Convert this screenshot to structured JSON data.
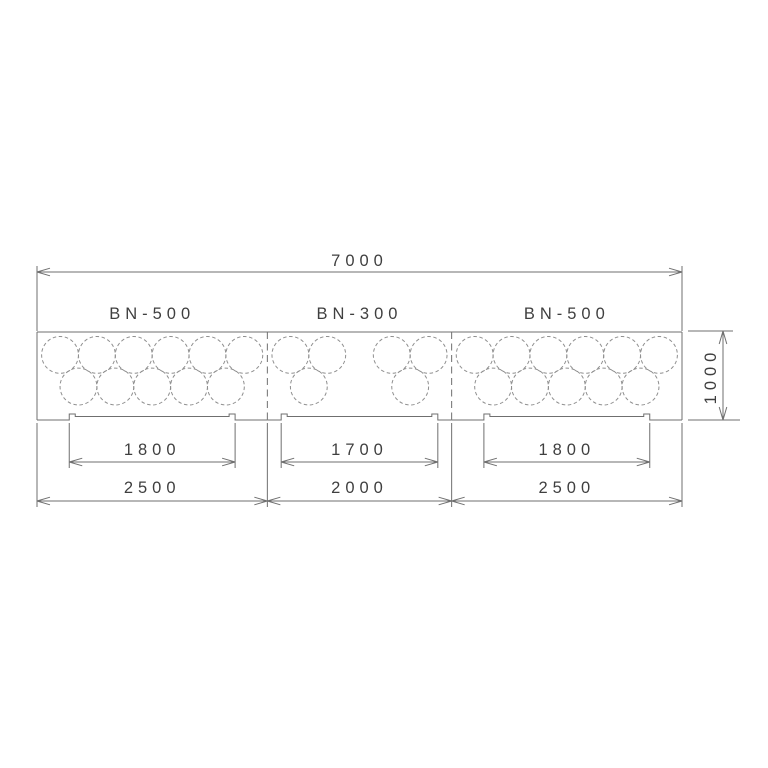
{
  "drawing": {
    "type": "plan-view-technical-drawing",
    "overall": {
      "length_label": "7000",
      "length_mm": 7000,
      "height_label": "1000",
      "height_mm": 1000
    },
    "sections": [
      {
        "label": "BN-500",
        "width_label": "2500",
        "width_mm": 2500,
        "opening_label": "1800",
        "opening_mm": 1800,
        "void_columns_top_mm": [
          250,
          650,
          1050,
          1450,
          1850,
          2250
        ],
        "void_columns_bottom_mm": [
          450,
          850,
          1250,
          1650,
          2050
        ]
      },
      {
        "label": "BN-300",
        "width_label": "2000",
        "width_mm": 2000,
        "opening_label": "1700",
        "opening_mm": 1700,
        "void_columns_top_mm": [
          250,
          650,
          1350,
          1750
        ],
        "void_columns_bottom_mm": [
          450,
          1550
        ]
      },
      {
        "label": "BN-500",
        "width_label": "2500",
        "width_mm": 2500,
        "opening_label": "1800",
        "opening_mm": 1800,
        "void_columns_top_mm": [
          250,
          650,
          1050,
          1450,
          1850,
          2250
        ],
        "void_columns_bottom_mm": [
          450,
          850,
          1250,
          1650,
          2050
        ]
      }
    ],
    "voids": {
      "diameter_mm": 400,
      "row_depths_mm": [
        260,
        620
      ],
      "line_style": "dashed"
    },
    "colors": {
      "line": "#6f6f6f",
      "dashed": "#8f8f8f",
      "text": "#3f3f3f",
      "background": "#ffffff"
    }
  }
}
